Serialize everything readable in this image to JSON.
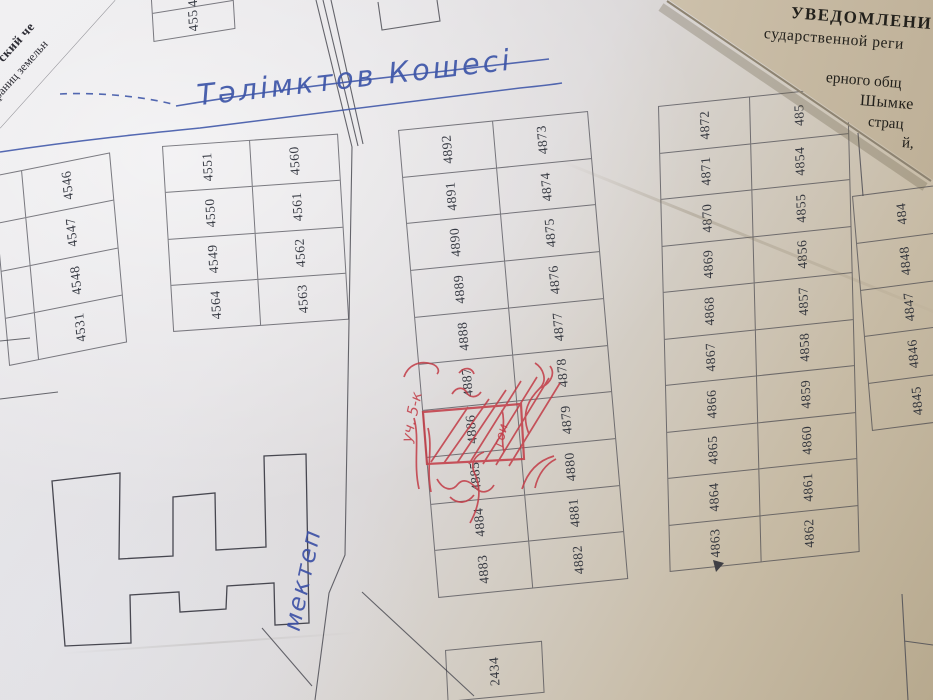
{
  "street": {
    "name_label": "Тәлімктов Кошесі",
    "ink_color": "#3d55a8"
  },
  "school": {
    "label": "мектеп"
  },
  "plots": {
    "top_strip": [
      "4552",
      "455"
    ],
    "left_block": [
      "4546",
      "4547",
      "4548",
      "4531"
    ],
    "second_block_left": [
      "4551",
      "4550",
      "4549",
      "4564"
    ],
    "second_block_right": [
      "4560",
      "4561",
      "4562",
      "4563"
    ],
    "middle_block_left": [
      "4892",
      "4891",
      "4890",
      "4889",
      "4888",
      "4887",
      "4886",
      "4885",
      "4884",
      "4883"
    ],
    "middle_block_right": [
      "4873",
      "4874",
      "4875",
      "4876",
      "4877",
      "4878",
      "4879",
      "4880",
      "4881",
      "4882"
    ],
    "right_block_left": [
      "4872",
      "4871",
      "4870",
      "4869",
      "4868",
      "4867",
      "4866",
      "4865",
      "4864",
      "4863"
    ],
    "right_block_right": [
      "485",
      "4854",
      "4855",
      "4856",
      "4857",
      "4858",
      "4859",
      "4860",
      "4861",
      "4862"
    ],
    "far_right_column": [
      "484",
      "4848",
      "4847",
      "4846",
      "4845"
    ],
    "standalone": [
      "2434"
    ]
  },
  "red_pen": {
    "marked_plot": "4886",
    "left_note": "уч. 5-к",
    "right_note": "гои",
    "color": "#c23b46"
  },
  "overlay_document": {
    "paper_color": "#d6c9b4",
    "lines": [
      "УВЕДОМЛЕНИ",
      "сударственной реги",
      "ерного общ",
      "Шымке",
      "страц",
      "й,"
    ]
  },
  "corner_document": {
    "lines": [
      "ский че",
      "раниц земельн"
    ]
  }
}
